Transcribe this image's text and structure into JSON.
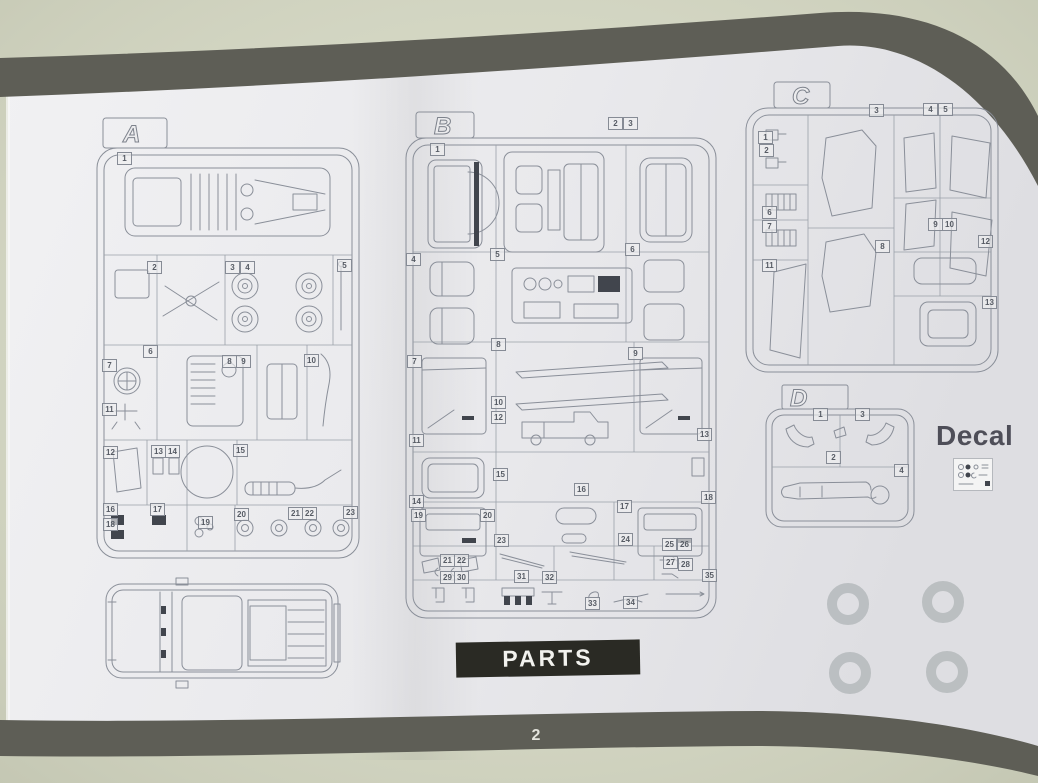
{
  "photo": {
    "table_color": "#d6d9c4",
    "band_color": "#5e5e56",
    "paper_color": "#ececee",
    "line_color": "#8a8f99",
    "banner_bg": "#2a2a24",
    "banner_text_color": "#f2f2ee",
    "ring_color": "#b2b6b9"
  },
  "sprues": [
    {
      "letter": "A",
      "parts": [
        "1",
        "2",
        "3",
        "4",
        "5",
        "6",
        "7",
        "8",
        "9",
        "10",
        "11",
        "12",
        "13",
        "14",
        "15",
        "16",
        "17",
        "18",
        "19",
        "20",
        "21",
        "22",
        "23"
      ]
    },
    {
      "letter": "B",
      "parts": [
        "1",
        "2",
        "3",
        "4",
        "5",
        "6",
        "7",
        "8",
        "9",
        "10",
        "11",
        "12",
        "13",
        "14",
        "15",
        "16",
        "17",
        "18",
        "19",
        "20",
        "21",
        "22",
        "23",
        "24",
        "25",
        "26",
        "27",
        "28",
        "29",
        "30",
        "31",
        "32",
        "33",
        "34",
        "35"
      ]
    },
    {
      "letter": "C",
      "parts": [
        "1",
        "2",
        "3",
        "4",
        "5",
        "6",
        "7",
        "8",
        "9",
        "10",
        "11",
        "12",
        "13"
      ]
    },
    {
      "letter": "D",
      "parts": [
        "1",
        "2",
        "3",
        "4"
      ]
    }
  ],
  "labels": {
    "decal": "Decal",
    "parts_banner": "PARTS",
    "page_number": "2"
  }
}
